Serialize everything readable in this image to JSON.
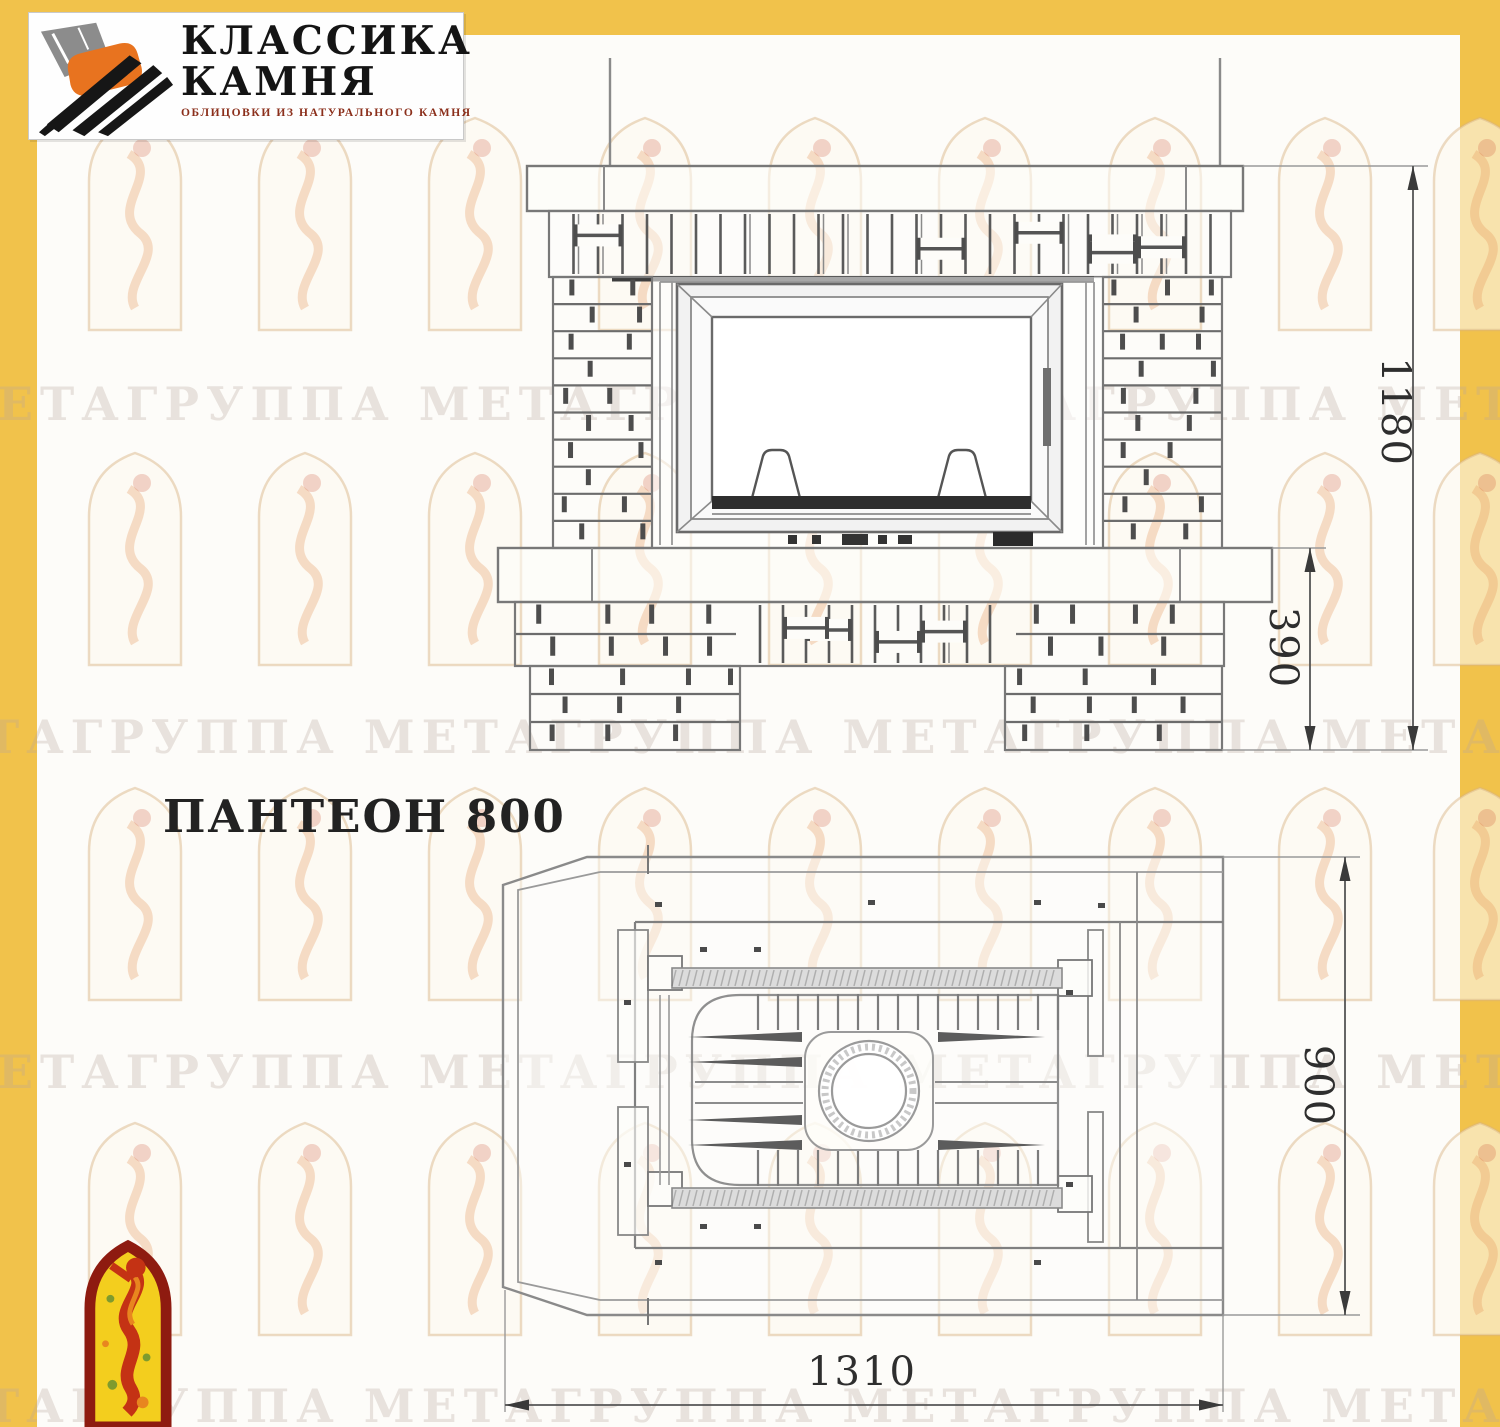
{
  "logo": {
    "line1": "КЛАССИКА",
    "line2": "КАМНЯ",
    "tagline": "ОБЛИЦОВКИ ИЗ НАТУРАЛЬНОГО КАМНЯ"
  },
  "title": "ПАНТЕОН 800",
  "watermark": {
    "text": "МЕТАГРУППА",
    "repeat": 5
  },
  "drawing": {
    "front_view": {
      "height_mm": "1180",
      "base_height_mm": "390"
    },
    "plan_view": {
      "depth_mm": "900",
      "width_mm": "1310"
    }
  },
  "colors": {
    "accent_yellow": "#F1C24B",
    "logo_orange": "#E8731F",
    "logo_black": "#161616",
    "stone_gray": "#8C8C8C",
    "tagline_red": "#8B2F1B",
    "mascot_red": "#C43214",
    "mascot_yellow": "#F3CE1E",
    "mascot_border": "#8E1B10",
    "drawing_line_gray": "#7a7a7a"
  }
}
